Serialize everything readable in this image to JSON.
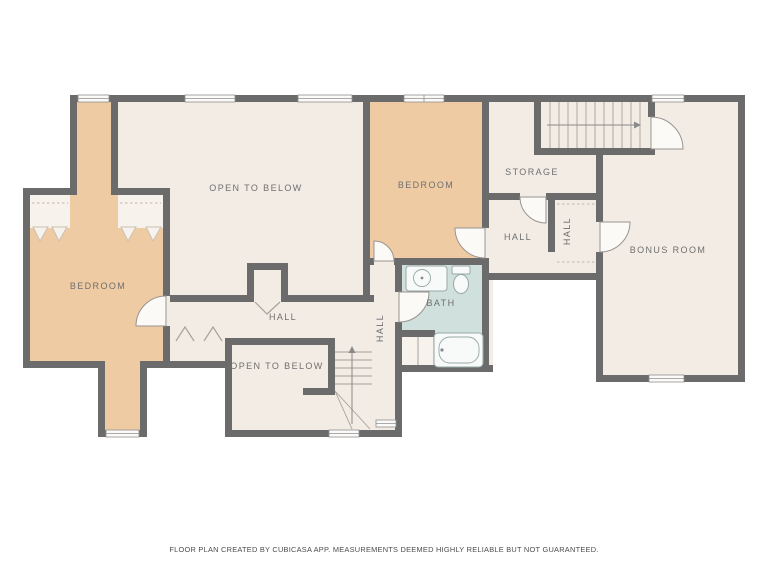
{
  "plan": {
    "rooms": {
      "open_to_below_top": {
        "label": "OPEN TO BELOW"
      },
      "bedroom_left": {
        "label": "BEDROOM"
      },
      "bedroom_center": {
        "label": "BEDROOM"
      },
      "storage": {
        "label": "STORAGE"
      },
      "hall_upper": {
        "label": "HALL"
      },
      "hall_closet": {
        "label": "HALL"
      },
      "bonus_room": {
        "label": "BONUS ROOM"
      },
      "bath": {
        "label": "BATH"
      },
      "hall_lower": {
        "label": "HALL"
      },
      "hall_stair": {
        "label": "HALL"
      },
      "open_to_below_bottom": {
        "label": "OPEN TO BELOW"
      }
    },
    "palette": {
      "wall": "#6b6b6b",
      "floor": "#f2ece4",
      "bedroom_fill": "#efcba4",
      "bath_fill": "#cfe0dd",
      "window_fill": "#fbfaf8",
      "label_text": "#6f6f6f"
    },
    "footer": {
      "disclaimer": "FLOOR PLAN CREATED BY CUBICASA APP. MEASUREMENTS DEEMED HIGHLY RELIABLE BUT NOT GUARANTEED."
    }
  }
}
